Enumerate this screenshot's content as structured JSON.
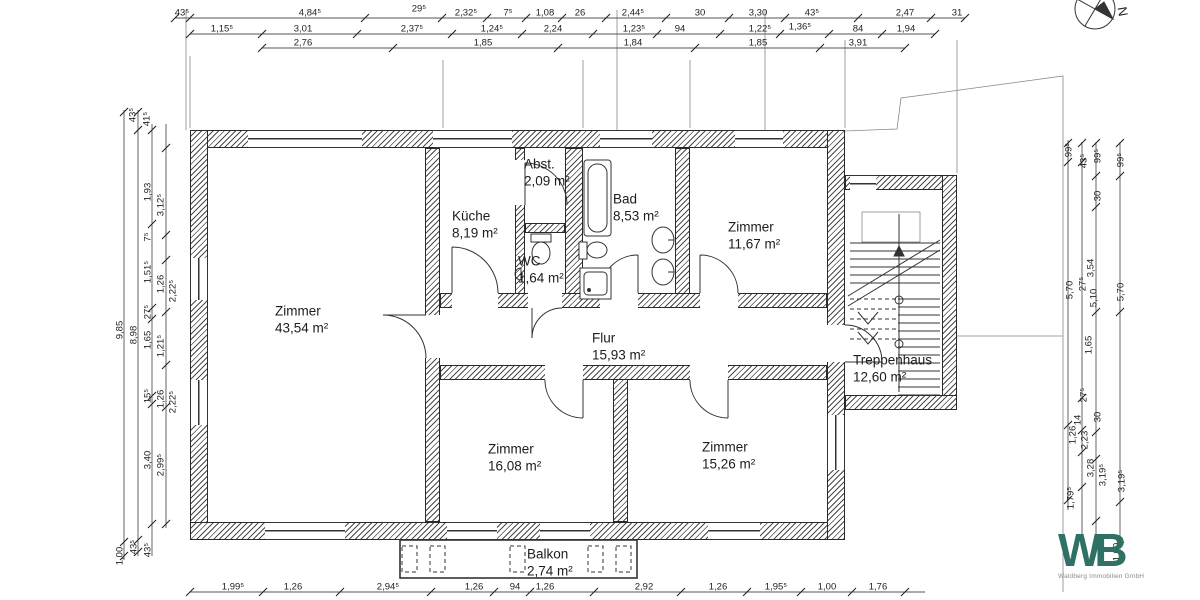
{
  "plan_title": "Grundriss Wohnung",
  "compass": {
    "label": "N"
  },
  "rooms": [
    {
      "name": "Zimmer",
      "area": "43,54 m²"
    },
    {
      "name": "Küche",
      "area": "8,19 m²"
    },
    {
      "name": "Abst.",
      "area": "2,09 m²"
    },
    {
      "name": "WC",
      "area": "1,64 m²"
    },
    {
      "name": "Bad",
      "area": "8,53 m²"
    },
    {
      "name": "Zimmer",
      "area": "11,67 m²"
    },
    {
      "name": "Flur",
      "area": "15,93 m²"
    },
    {
      "name": "Zimmer",
      "area": "16,08 m²"
    },
    {
      "name": "Zimmer",
      "area": "15,26 m²"
    },
    {
      "name": "Treppenhaus",
      "area": "12,60 m²"
    },
    {
      "name": "Balkon",
      "area": "2,74 m²"
    }
  ],
  "dims": {
    "top_row1": [
      "43⁵",
      "4,84⁵",
      "29⁵",
      "2,32⁵",
      "7⁵",
      "1,08",
      "26",
      "2,44⁵",
      "30",
      "3,30",
      "43⁵",
      "2,47",
      "31"
    ],
    "top_row2": [
      "1,15⁵",
      "3,01",
      "2,37⁵",
      "1,24⁵",
      "2,24",
      "1,23⁵",
      "94",
      "1,22⁵",
      "1,36⁵",
      "84",
      "1,94"
    ],
    "top_row3": [
      "2,76",
      "1,85",
      "1,84",
      "1,85",
      "3,91"
    ],
    "bottom": [
      "1,99⁵",
      "1,26",
      "2,94⁵",
      "1,26",
      "94",
      "1,26",
      "2,92",
      "1,26",
      "1,95⁵",
      "1,00",
      "1,76"
    ],
    "left": [
      "43⁵",
      "41⁵",
      "9,85",
      "8,98",
      "1,93",
      "3,12⁵",
      "7⁵",
      "1,51⁵",
      "1,26",
      "2,22⁵",
      "27⁵",
      "1,65",
      "1,21⁵",
      "15⁵",
      "1,26",
      "2,22⁵",
      "3,40",
      "2,99⁵",
      "1,00",
      "43⁵",
      "43⁵"
    ],
    "right": [
      "99⁵",
      "43⁵",
      "99⁵",
      "99⁵",
      "30",
      "3,54",
      "5,70",
      "27⁵",
      "5,10",
      "5,70",
      "1,65",
      "27⁵",
      "14",
      "30",
      "1,26",
      "2,23",
      "3,28",
      "3,19⁵",
      "3,19⁵",
      "1,79⁵",
      "1,00"
    ]
  },
  "logo": {
    "text": "WB",
    "subtext": "Waldberg Immobilien GmbH"
  },
  "colors": {
    "logo_teal": "#2f7164",
    "wall_line": "#2a2a2a"
  }
}
